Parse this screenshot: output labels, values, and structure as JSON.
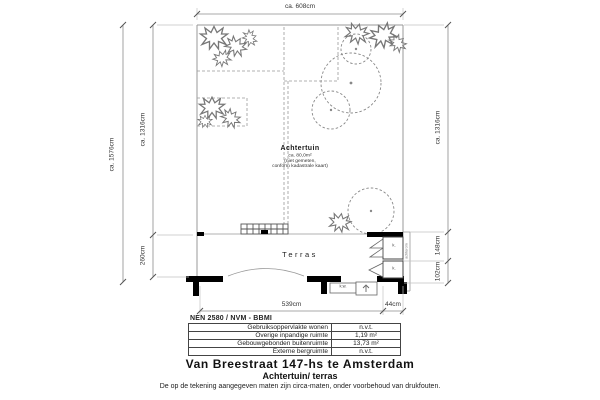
{
  "plan": {
    "dimensions": {
      "top": "ca. 608cm",
      "left_outer": "ca. 1576cm",
      "left_inner_top": "ca. 1316cm",
      "left_inner_bottom": "260cm",
      "right_top": "ca. 1316cm",
      "right_middle": "148cm",
      "right_bottom": "102cm",
      "bottom_main": "539cm",
      "bottom_right": "44cm"
    },
    "labels": {
      "garden_title": "Achtertuin",
      "garden_area": "ca. 80,0m²",
      "garden_note1": "(niet gemeten,",
      "garden_note2": "conform kadastrale kaart)",
      "terrace": "Terras",
      "closet_top": "k.",
      "closet_bottom": "k.",
      "kitchen_window": "k.w.",
      "side_note": "achterom"
    }
  },
  "table": {
    "header": "NEN 2580 / NVM - BBMI",
    "rows": [
      {
        "label": "Gebruiksoppervlakte wonen",
        "value": "n.v.t."
      },
      {
        "label": "Overige inpandige ruimte",
        "value": "1,19 m²"
      },
      {
        "label": "Gebouwgebonden buitenruimte",
        "value": "13,73 m²"
      },
      {
        "label": "Externe bergruimte",
        "value": "n.v.t."
      }
    ]
  },
  "footer": {
    "title": "Van Breestraat 147-hs te Amsterdam",
    "subtitle": "Achtertuin/ terras",
    "disclaimer": "De op de tekening aangegeven maten zijn circa-maten, onder voorbehoud van drukfouten."
  },
  "colors": {
    "line": "#8c8c8c",
    "wall": "#000000",
    "text": "#1a1a1a"
  }
}
